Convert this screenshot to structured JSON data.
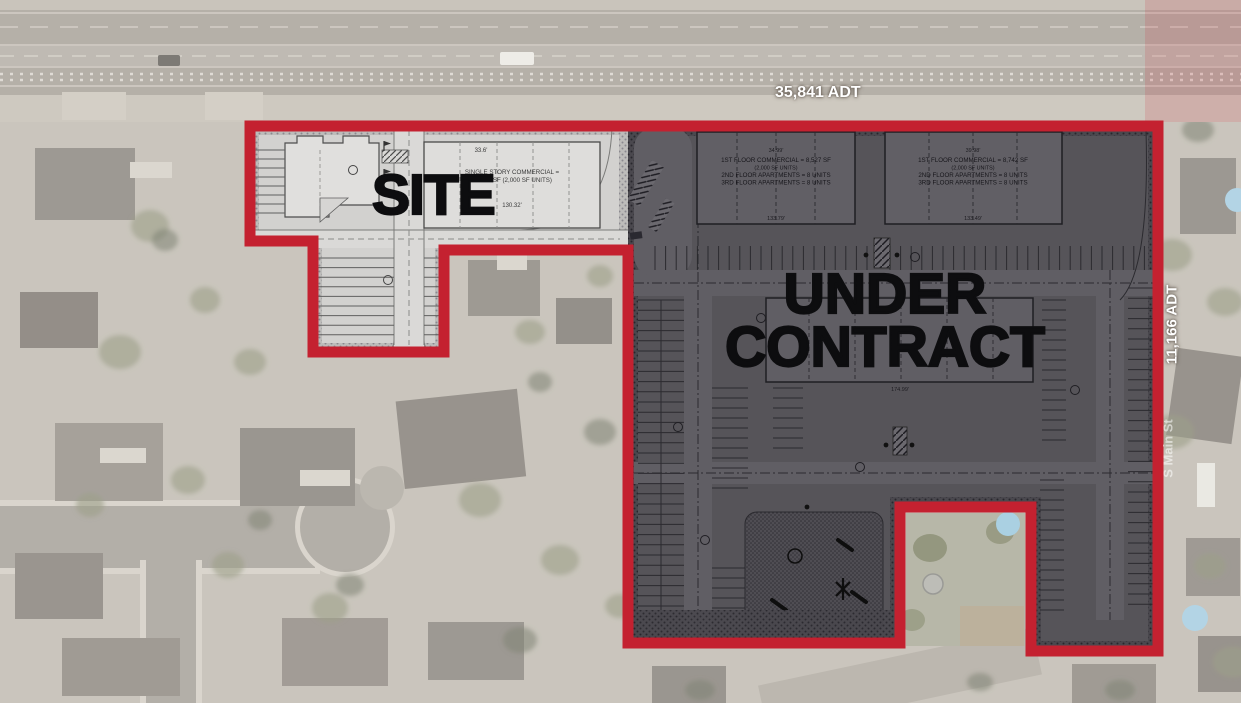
{
  "canvas": {
    "width": 1241,
    "height": 703
  },
  "colors": {
    "boundary_red": "#c42130",
    "dark_overlay": "#565459",
    "plan_paper": "#d2d1cf",
    "label_black": "#0d0d0f",
    "adt_white": "#ffffff"
  },
  "labels": {
    "site": "SITE",
    "under_contract_line1": "UNDER",
    "under_contract_line2": "CONTRACT",
    "adt_top": "35,841 ADT",
    "adt_right": "11,166 ADT",
    "street_right": "S Main St"
  },
  "plan": {
    "commercial_building": {
      "line1": "SINGLE STORY COMMERCIAL =",
      "line2": "TOTAL SF (2,000 SF UNITS)",
      "dim_top": "33.6'",
      "dim_bottom": "130.32'"
    },
    "building_a": {
      "line1": "1ST FLOOR COMMERCIAL = 8,527 SF",
      "line2": "(2,000 SF UNITS)",
      "line3": "2ND FLOOR APARTMENTS = 8 UNITS",
      "line4": "3RD FLOOR APARTMENTS = 8 UNITS",
      "dim_top": "34.99'",
      "dim_bottom": "133.79'"
    },
    "building_b": {
      "line1": "1ST FLOOR COMMERCIAL = 8,742 SF",
      "line2": "(2,000 SF UNITS)",
      "line3": "2ND FLOOR APARTMENTS = 8 UNITS",
      "line4": "3RD FLOOR APARTMENTS = 8 UNITS",
      "dim_top": "39.98'",
      "dim_bottom": "133.49'"
    },
    "central_dim": "174.99'"
  }
}
